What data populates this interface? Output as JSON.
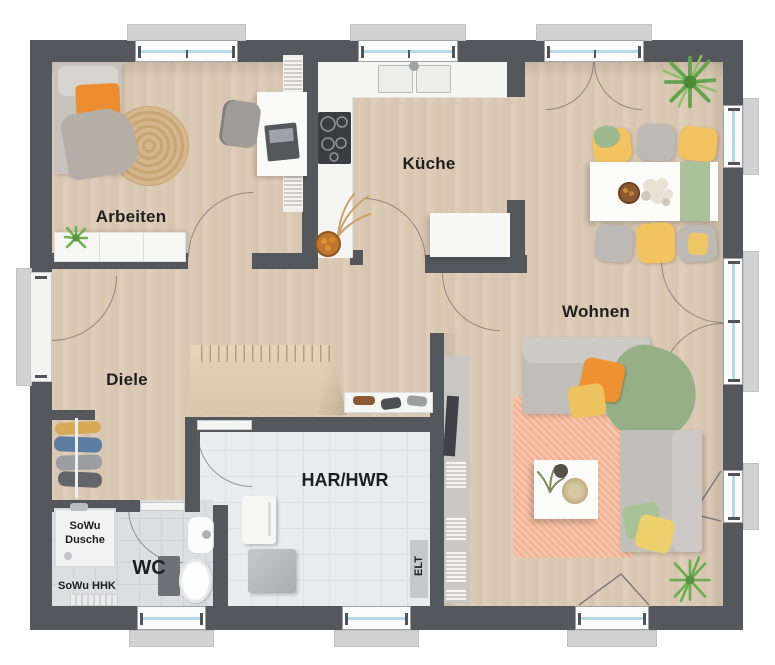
{
  "rooms": {
    "arbeiten": {
      "label": "Arbeiten"
    },
    "kueche": {
      "label": "Küche"
    },
    "wohnen": {
      "label": "Wohnen"
    },
    "diele": {
      "label": "Diele"
    },
    "wc": {
      "label": "WC"
    },
    "har_hwr": {
      "label": "HAR/HWR"
    },
    "elt": {
      "label": "ELT"
    },
    "sowu_dusche": {
      "label": "SoWu Dusche"
    },
    "sowu_hhk": {
      "label": "SoWu HHK"
    }
  },
  "colors": {
    "wall": "#54575c",
    "floor_wood": "#d8c7b2",
    "tile_wc": "#dcdee1",
    "tile_har": "#eaebed",
    "window_glass": "#b5d9e8",
    "accent_orange": "#ee8d2f",
    "accent_yellow": "#f2c35e",
    "accent_green": "#95af86",
    "rug_orange": "#f3b595",
    "rug_jute": "#d0ad7e",
    "plant_green": "#5e9c45"
  }
}
